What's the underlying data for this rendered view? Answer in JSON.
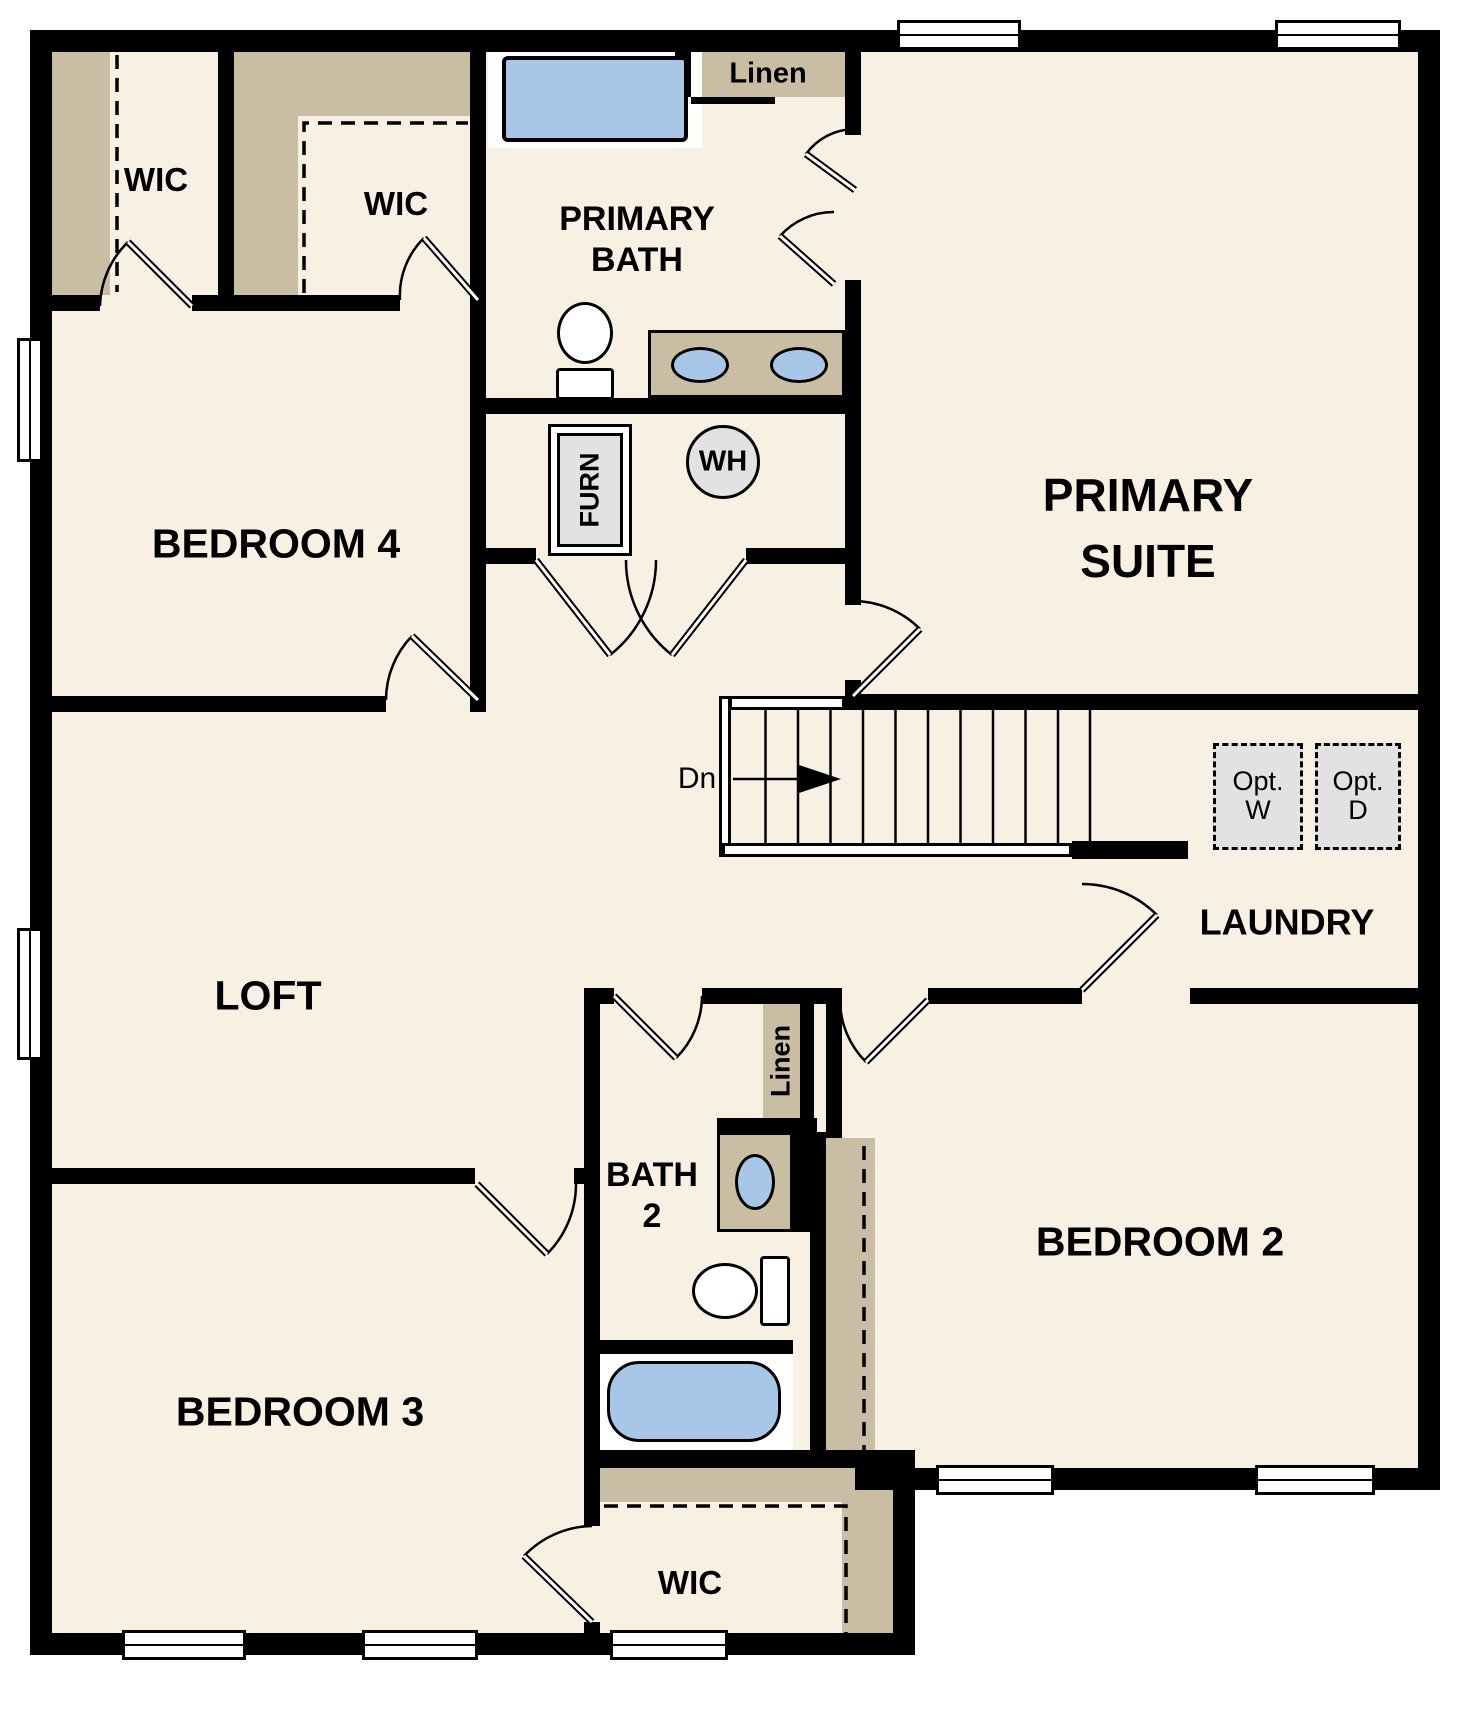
{
  "floor_plan": {
    "rooms": {
      "wic_top_left": "WIC",
      "wic_top_mid": "WIC",
      "primary_bath_line1": "PRIMARY",
      "primary_bath_line2": "BATH",
      "linen_top": "Linen",
      "primary_suite_line1": "PRIMARY",
      "primary_suite_line2": "SUITE",
      "bedroom4": "BEDROOM 4",
      "loft": "LOFT",
      "laundry": "LAUNDRY",
      "bath2_line1": "BATH",
      "bath2_line2": "2",
      "linen_bath2": "Linen",
      "bedroom2": "BEDROOM 2",
      "bedroom3": "BEDROOM 3",
      "wic_bottom": "WIC"
    },
    "equipment": {
      "furnace": "FURN",
      "water_heater": "WH",
      "stair_direction": "Dn",
      "opt_washer_line1": "Opt.",
      "opt_washer_line2": "W",
      "opt_dryer_line1": "Opt.",
      "opt_dryer_line2": "D"
    },
    "colors": {
      "floor": "#f8f0e3",
      "wall": "#000000",
      "closet_shelf": "#c9bda3",
      "fixture_blue": "#a8c7e8",
      "appliance_gray": "#e2e2e2",
      "background": "#ffffff"
    }
  }
}
